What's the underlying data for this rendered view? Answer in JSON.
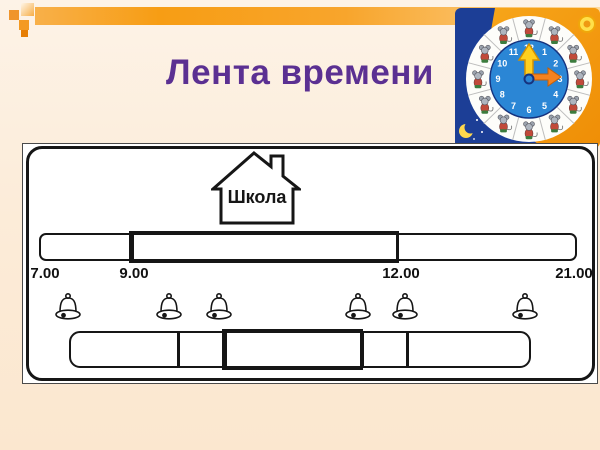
{
  "slide": {
    "title": "Лента времени",
    "colors": {
      "title_purple": "#5b3092",
      "band_orange": "#f79d14",
      "background_cream": "#fcecd9",
      "diagram_ink": "#161616"
    }
  },
  "diagram": {
    "house_label": "Школа",
    "timeline_labels": [
      "7.00",
      "9.00",
      "12.00",
      "21.00"
    ],
    "bells_count": 6
  },
  "clock": {
    "numbers": [
      "12",
      "1",
      "2",
      "3",
      "4",
      "5",
      "6",
      "7",
      "8",
      "9",
      "10",
      "11"
    ],
    "hands": {
      "yellow_arrow_points_to": "12",
      "orange_arrow_points_to": "3"
    }
  }
}
